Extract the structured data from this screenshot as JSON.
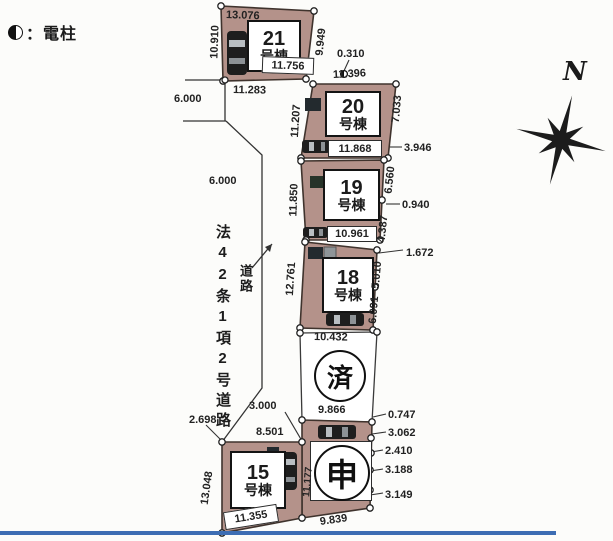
{
  "legend": {
    "icon": "half-filled-circle",
    "label": "：電柱"
  },
  "compass": {
    "north_label": "N"
  },
  "road": {
    "name": "法42条1項2号道路",
    "callout": "道路",
    "width_top": "6.000",
    "width_mid": "6.000",
    "width_bend": "3.000"
  },
  "lots": {
    "b21": {
      "number": "21",
      "suffix": "号棟",
      "dim_top": "13.076",
      "dim_left": "10.910",
      "dim_right": "9.949",
      "dim_inner_bottom": "11.756",
      "dim_below": "11.283"
    },
    "b20": {
      "number": "20",
      "suffix": "号棟",
      "dim_top": "11.396",
      "dim_left": "11.207",
      "dim_right": "7.033",
      "dim_bottom": "11.868"
    },
    "b19": {
      "number": "19",
      "suffix": "号棟",
      "dim_left": "11.850",
      "dim_right_upper": "6.560",
      "dim_right_lower": "4.387",
      "dim_bottom": "10.961"
    },
    "b18": {
      "number": "18",
      "suffix": "号棟",
      "dim_left": "12.761",
      "dim_right_upper": "5.010",
      "dim_right_lower": "6.091",
      "dim_bottom": "10.432"
    },
    "b15": {
      "number": "15",
      "suffix": "号棟",
      "dim_corner": "2.698",
      "dim_top": "8.501",
      "dim_left": "13.048",
      "dim_bottom": "11.355"
    },
    "sold": {
      "mark": "済",
      "dim_bottom": "9.866"
    },
    "applied": {
      "mark": "申",
      "dim_left": "11.177",
      "dim_bottom": "9.839"
    }
  },
  "callouts": {
    "c0310": "0.310",
    "c3946": "3.946",
    "c0940": "0.940",
    "c1672": "1.672",
    "c0747": "0.747",
    "c3062": "3.062",
    "c2410": "2.410",
    "c3188": "3.188",
    "c3149": "3.149"
  },
  "colors": {
    "lot_fill": "#b4928a",
    "outline": "#3f332d",
    "divider_blue": "#3d6db3",
    "text": "#1b1b1b"
  }
}
